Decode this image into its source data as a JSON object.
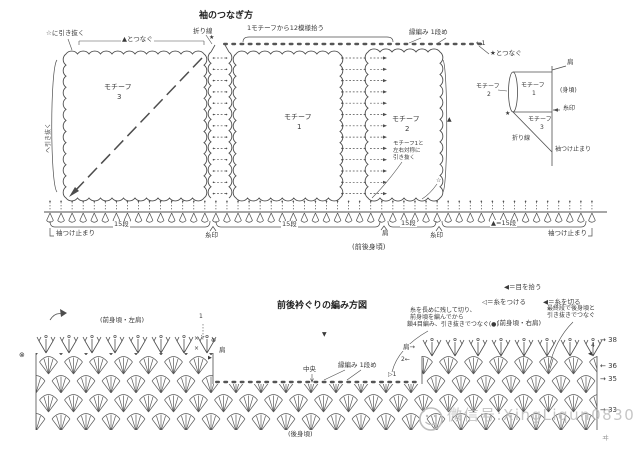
{
  "top": {
    "title": "袖のつなぎ方",
    "slip_star": "☆に引き抜く",
    "join_tri": "▲とつなぐ",
    "fold": "折り線",
    "star": "★",
    "pickup": "1モチーフから12模様拾う",
    "edging": "縁編み 1段め",
    "row1": "←1",
    "join_star": "★とつなぐ",
    "motif3": {
      "name": "モチーフ",
      "num": "3"
    },
    "motif1": {
      "name": "モチーフ",
      "num": "1"
    },
    "motif2": {
      "name": "モチーフ",
      "num": "2"
    },
    "motif2_note": [
      "モチーフ1と",
      "左右対称に",
      "引き抜く"
    ],
    "tri": "▲",
    "star_open": "☆",
    "side_note": "へ引き抜く",
    "dims": {
      "sleeve_stop_l": "袖つけ止まり",
      "len_a": "15段",
      "mark_a": "糸印",
      "len_b": "15段",
      "shoulder": "肩",
      "body": "(前後身頃)",
      "len_c": "15段",
      "mark_b": "糸印",
      "len_d": "▲=15段",
      "sleeve_stop_r": "袖つけ止まり"
    }
  },
  "inset": {
    "shoulder": "肩",
    "motif2": {
      "name": "モチーフ",
      "num": "2"
    },
    "motif1": {
      "name": "モチーフ",
      "num": "1"
    },
    "motif3": {
      "name": "モチーフ",
      "num": "3"
    },
    "body": "(身頃)",
    "mark": "糸印",
    "star": "★",
    "fold": "折り線",
    "sleeve_stop": "袖つけ止まり"
  },
  "bottom": {
    "title": "前後衿ぐりの編み方図",
    "legend": [
      {
        "sym": "◀",
        "text": "＝目を拾う"
      },
      {
        "sym": "◁",
        "text": "＝糸をつける"
      },
      {
        "sym": "◀",
        "text": "＝糸を切る"
      }
    ],
    "note_cut": [
      "糸を長めに残して切り、",
      "前身頃を編んでから",
      "鎖4目編み、引き抜きでつなぐ(●)"
    ],
    "note_join": [
      "最終段で後身頃と",
      "引き抜きでつなぐ"
    ],
    "front_left": "(前身頃・左肩)",
    "front_right": "(前身頃・右肩)",
    "back": "(後身頃)",
    "center": "中央",
    "edging": "縁編み 1段め",
    "shoulder_l": "肩",
    "shoulder_r": "肩→",
    "two": "2←",
    "one": "1",
    "d1": "▷1",
    "four": "4",
    "marks": {
      "x": "×",
      "plus": "⊕",
      "tri_r": "▶",
      "tri_l": "◀",
      "otimes": "⊗",
      "tri_b": "▼"
    },
    "rows": [
      "→ 38",
      "← 36",
      "→ 35",
      "→ 33"
    ],
    "watermark": "微信号:XingLiqun0830",
    "corner": "ヰ"
  }
}
